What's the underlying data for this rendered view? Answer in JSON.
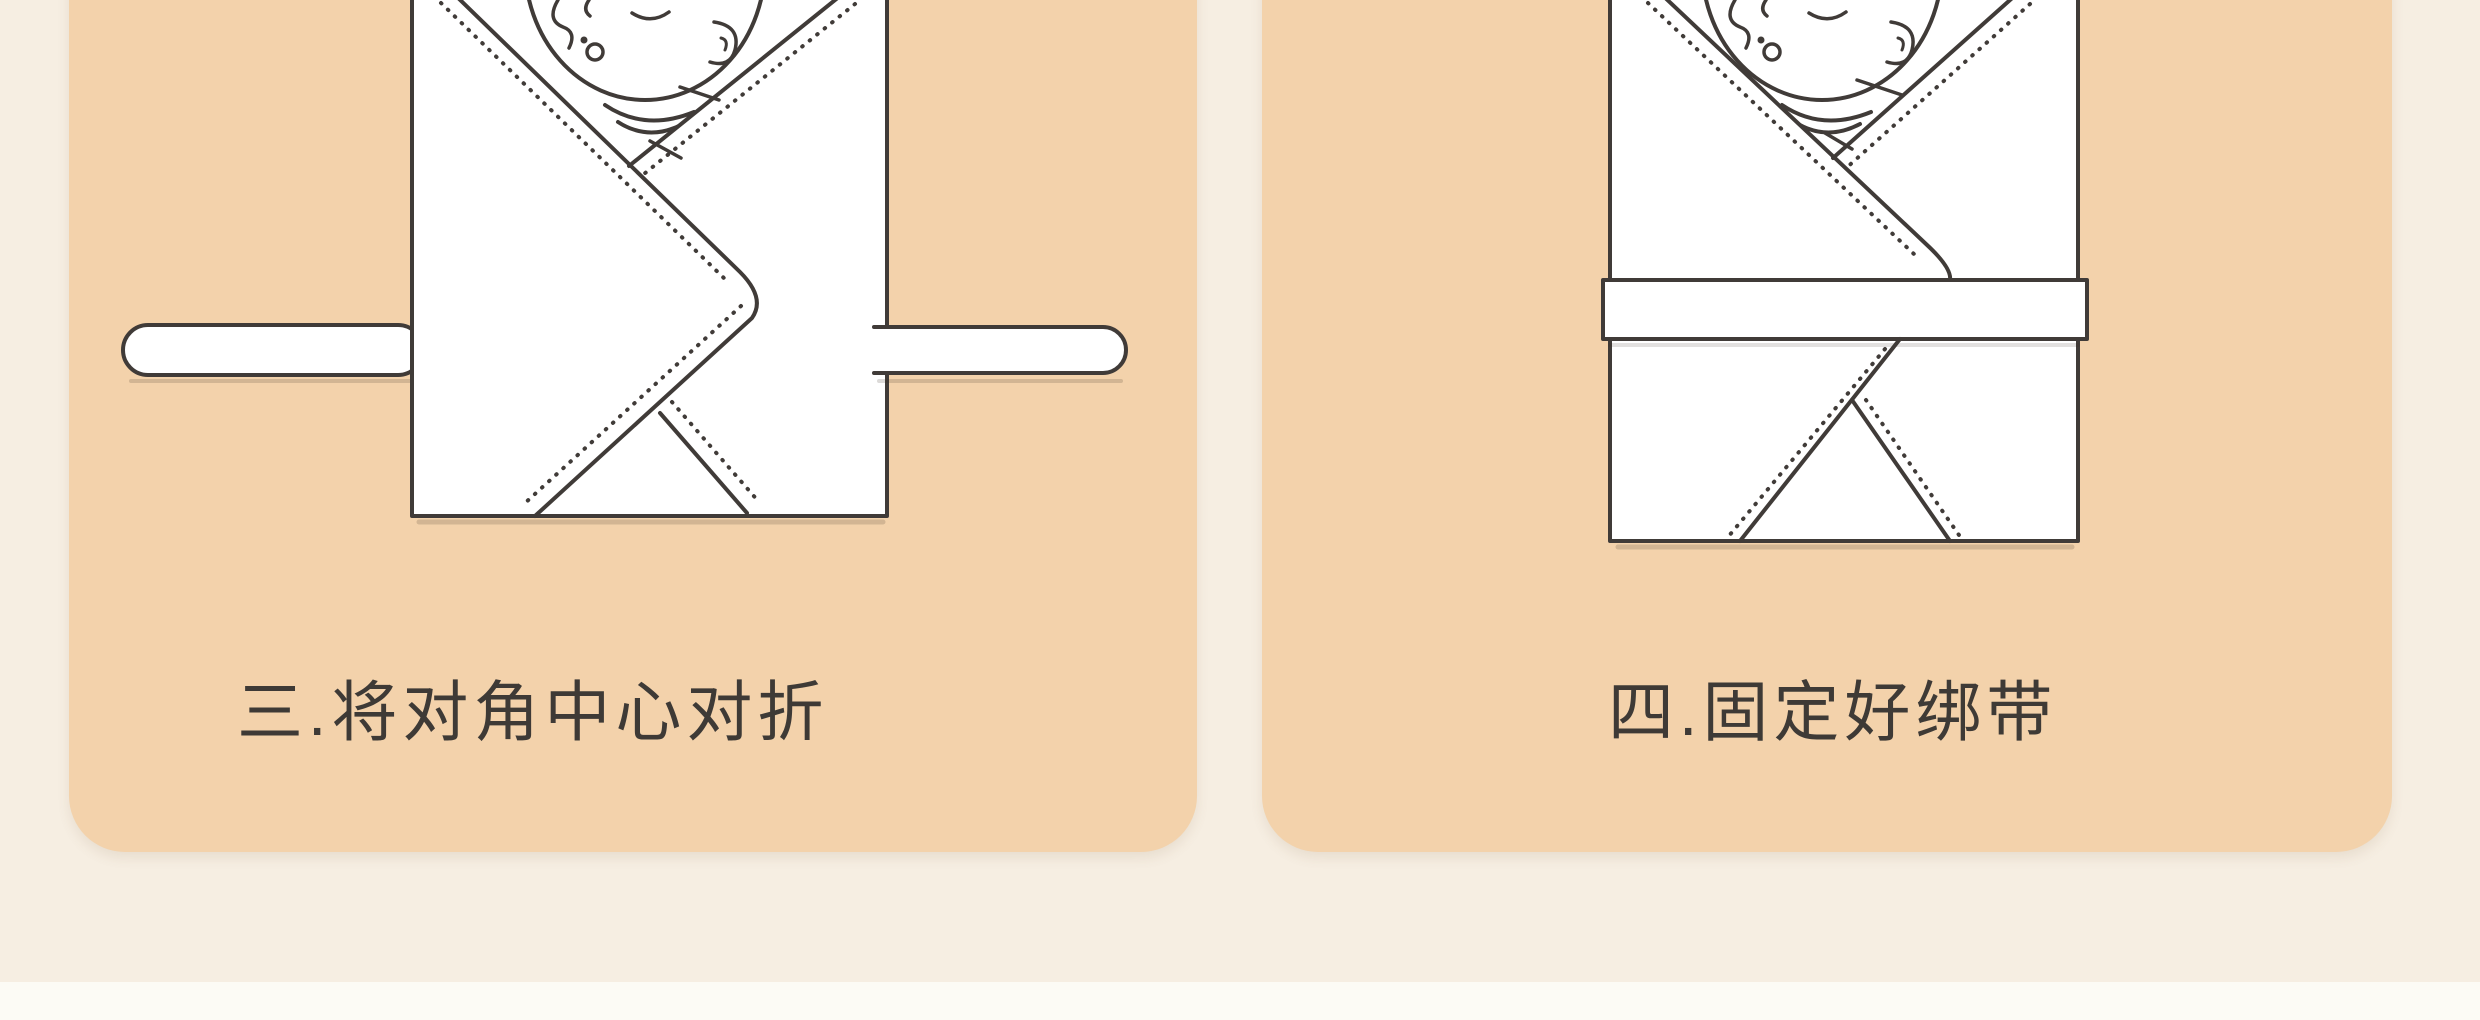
{
  "page": {
    "background_color": "#f6eee2",
    "footer_strip_color": "#fcfbf5",
    "card_color": "#f3d2ab",
    "line_color": "#403b38",
    "text_color": "#3e3a36"
  },
  "steps": [
    {
      "caption": "三.将对角中心对折",
      "illustration": "swaddled-baby-loose-tie-strap"
    },
    {
      "caption": "四.固定好绑带",
      "illustration": "swaddled-baby-fastened-band"
    }
  ]
}
